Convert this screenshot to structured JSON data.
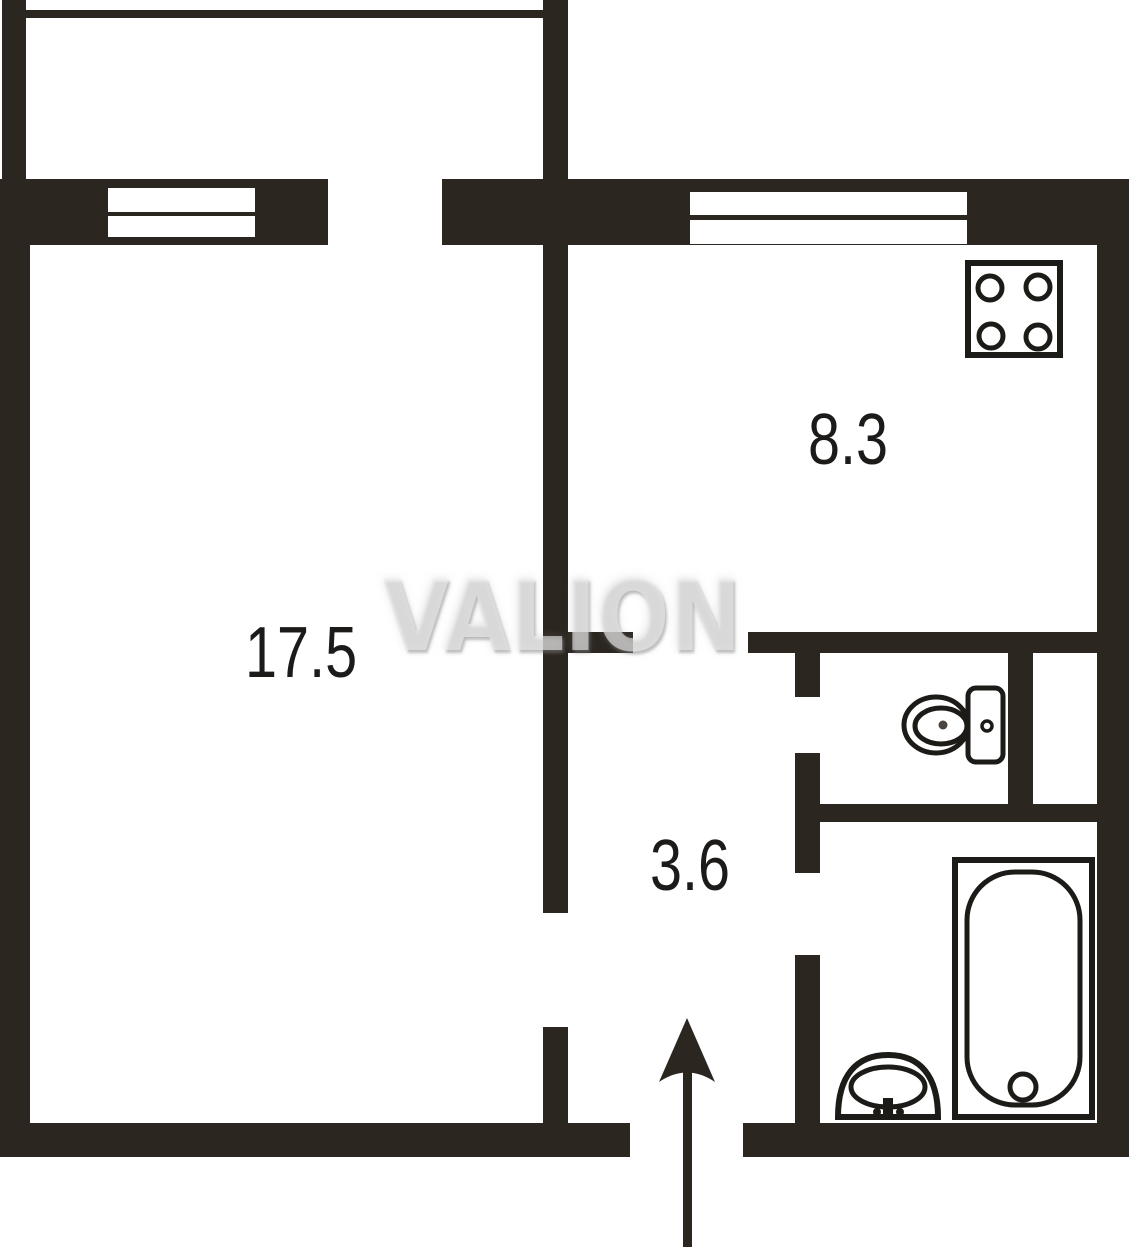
{
  "title": "Apartment floor plan",
  "watermark": {
    "text": "VALION"
  },
  "rooms": {
    "living": {
      "name": "living-room",
      "area": "17.5"
    },
    "kitchen": {
      "name": "kitchen",
      "area": "8.3"
    },
    "hallway": {
      "name": "hallway",
      "area": "3.6"
    }
  },
  "fixtures": {
    "stove": "stove-4-burner-icon",
    "toilet": "toilet-icon",
    "bathtub": "bathtub-icon",
    "sink": "sink-icon",
    "entrance": "entrance-arrow-icon"
  },
  "colors": {
    "background": "#ffffff",
    "wall": "#2b2620",
    "fixture_line": "#1d1b18",
    "label_text": "#1c1b19",
    "watermark": "#ededed"
  }
}
